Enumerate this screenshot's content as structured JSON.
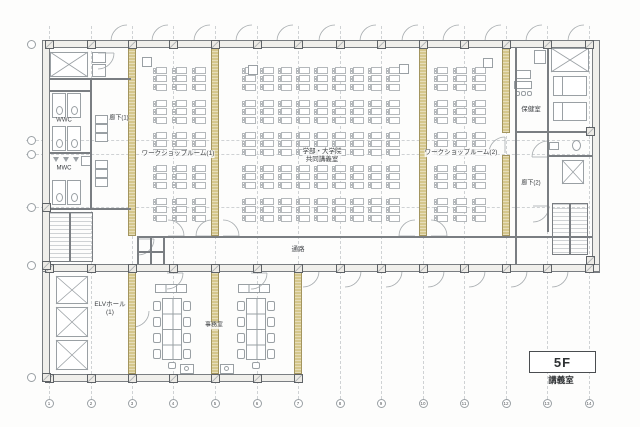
{
  "colors": {
    "paper": "#fdfdfc",
    "line": "#9aa0a4",
    "line_dark": "#7a7e82",
    "line_light": "#cfd2d4",
    "wall_fill": "#f0efeb",
    "partition": "#d5c78c",
    "partition_edge": "#a3955f",
    "text": "#3c3f42"
  },
  "title_block": {
    "floor": "5F",
    "caption": "講義室"
  },
  "labels": {
    "corridor1": "廊下(1)",
    "wwc": "WWC",
    "mwc": "MWC",
    "workshop1": "ワークショップルーム(1)",
    "main_room_line1": "学部・大学院",
    "main_room_line2": "共同講義室",
    "workshop2": "ワークショップルーム(2)",
    "health_room": "保健室",
    "corridor2": "廊下(2)",
    "elv_hall_line1": "ELVホール",
    "elv_hall_line2": "(1)",
    "office": "事務室",
    "passage": "通路"
  },
  "grid": {
    "column_xs": [
      49,
      91,
      132,
      173,
      215,
      257,
      298,
      340,
      381,
      423,
      464,
      506,
      547,
      589
    ],
    "bottom_labels": [
      "1",
      "2",
      "3",
      "4",
      "5",
      "6",
      "7",
      "8",
      "9",
      "10",
      "11",
      "12",
      "13",
      "14"
    ],
    "bottom_bubble_y": 403,
    "left_bubble_x": 31,
    "left_bubble_ys": [
      44,
      140,
      154,
      207,
      265,
      377
    ],
    "left_bubble_labels": [
      "",
      "",
      "",
      "",
      "",
      ""
    ],
    "h_dash_ys": [
      140,
      154,
      207
    ]
  },
  "plan": {
    "partitions": [
      [
        128,
        48,
        8,
        188
      ],
      [
        211,
        48,
        8,
        188
      ],
      [
        419,
        48,
        8,
        188
      ],
      [
        502,
        48,
        8,
        85
      ],
      [
        502,
        155,
        8,
        81
      ],
      [
        128,
        272,
        8,
        102
      ],
      [
        211,
        272,
        8,
        102
      ],
      [
        294,
        272,
        8,
        102
      ]
    ],
    "extra_columns": [
      [
        41.5,
        202.5
      ],
      [
        41.5,
        260.5
      ],
      [
        41.5,
        372.5
      ],
      [
        585.5,
        126.5
      ],
      [
        585.5,
        255.5
      ]
    ],
    "xboxes": [
      [
        50,
        52,
        38,
        25
      ],
      [
        551,
        48,
        38,
        24
      ],
      [
        562,
        160,
        22,
        24
      ],
      [
        56,
        276,
        32,
        28
      ],
      [
        56,
        307,
        32,
        30
      ],
      [
        56,
        340,
        32,
        30
      ]
    ],
    "desk_layout": {
      "band_ys": [
        67,
        100,
        132,
        165,
        198
      ],
      "rows_per_band": 3,
      "row_pitch": 8.3,
      "desk_w": 16,
      "desk_h": 7
    },
    "desk_grids": [
      {
        "room": "workshop-room-1",
        "x": 151,
        "cols": 3,
        "pitch": 19.5
      },
      {
        "room": "main-lecture-room",
        "x": 240,
        "cols": 9,
        "pitch": 18
      },
      {
        "room": "workshop-room-2",
        "x": 432,
        "cols": 3,
        "pitch": 19
      }
    ],
    "podiums": [
      [
        142,
        57,
        10,
        10
      ],
      [
        248,
        65,
        10,
        10
      ],
      [
        399,
        64,
        10,
        10
      ],
      [
        483,
        58,
        10,
        10
      ]
    ],
    "office_rooms": [
      {
        "cx": 172,
        "cab_x": 155
      },
      {
        "cx": 256,
        "cab_x": 238
      }
    ],
    "printers": [
      [
        180,
        364
      ],
      [
        220,
        364
      ]
    ],
    "beds": [
      [
        553,
        76,
        34,
        20
      ],
      [
        553,
        102,
        34,
        19
      ]
    ],
    "stalls": [
      [
        52,
        93,
        14,
        25
      ],
      [
        67,
        93,
        14,
        25
      ],
      [
        52,
        126,
        14,
        25
      ],
      [
        67,
        126,
        14,
        25
      ],
      [
        52,
        180,
        14,
        25
      ],
      [
        67,
        180,
        14,
        25
      ]
    ],
    "urinal_xs": [
      53,
      63,
      73
    ],
    "urinal_y": 157,
    "sinks": {
      "x": 95,
      "w": 13,
      "h": 9,
      "ys": [
        115,
        124,
        133,
        160,
        169,
        178
      ]
    },
    "health_desk": {
      "tables": [
        [
          516,
          70,
          15,
          9
        ],
        [
          514,
          81,
          18,
          8
        ]
      ],
      "chairs": [
        [
          515,
          91
        ],
        [
          521,
          91
        ],
        [
          527,
          91
        ]
      ]
    },
    "door_arcs": [
      [
        168,
        236,
        184,
        236,
        168,
        220,
        0
      ],
      [
        212,
        236,
        196,
        236,
        212,
        220,
        1
      ],
      [
        223,
        236,
        239,
        236,
        223,
        220,
        0
      ],
      [
        415,
        236,
        399,
        236,
        415,
        220,
        1
      ],
      [
        431,
        236,
        447,
        236,
        431,
        220,
        0
      ],
      [
        167,
        273,
        183,
        273,
        167,
        289,
        1
      ],
      [
        251,
        273,
        267,
        273,
        251,
        289,
        1
      ],
      [
        138,
        239,
        154,
        239,
        138,
        255,
        1
      ],
      [
        98,
        53,
        114,
        53,
        98,
        69,
        1
      ],
      [
        505,
        153,
        505,
        137,
        489,
        153,
        0
      ],
      [
        533,
        206,
        549,
        206,
        533,
        222,
        1
      ],
      [
        548,
        157,
        532,
        157,
        548,
        141,
        1
      ],
      [
        133,
        311,
        133,
        327,
        149,
        311,
        0
      ]
    ],
    "top_arc_bays": [
      1,
      2,
      3,
      4,
      5,
      6,
      7,
      8,
      9,
      10,
      11,
      12
    ],
    "south_arc_bays": [
      6,
      7,
      8,
      9,
      10,
      11,
      12
    ]
  }
}
